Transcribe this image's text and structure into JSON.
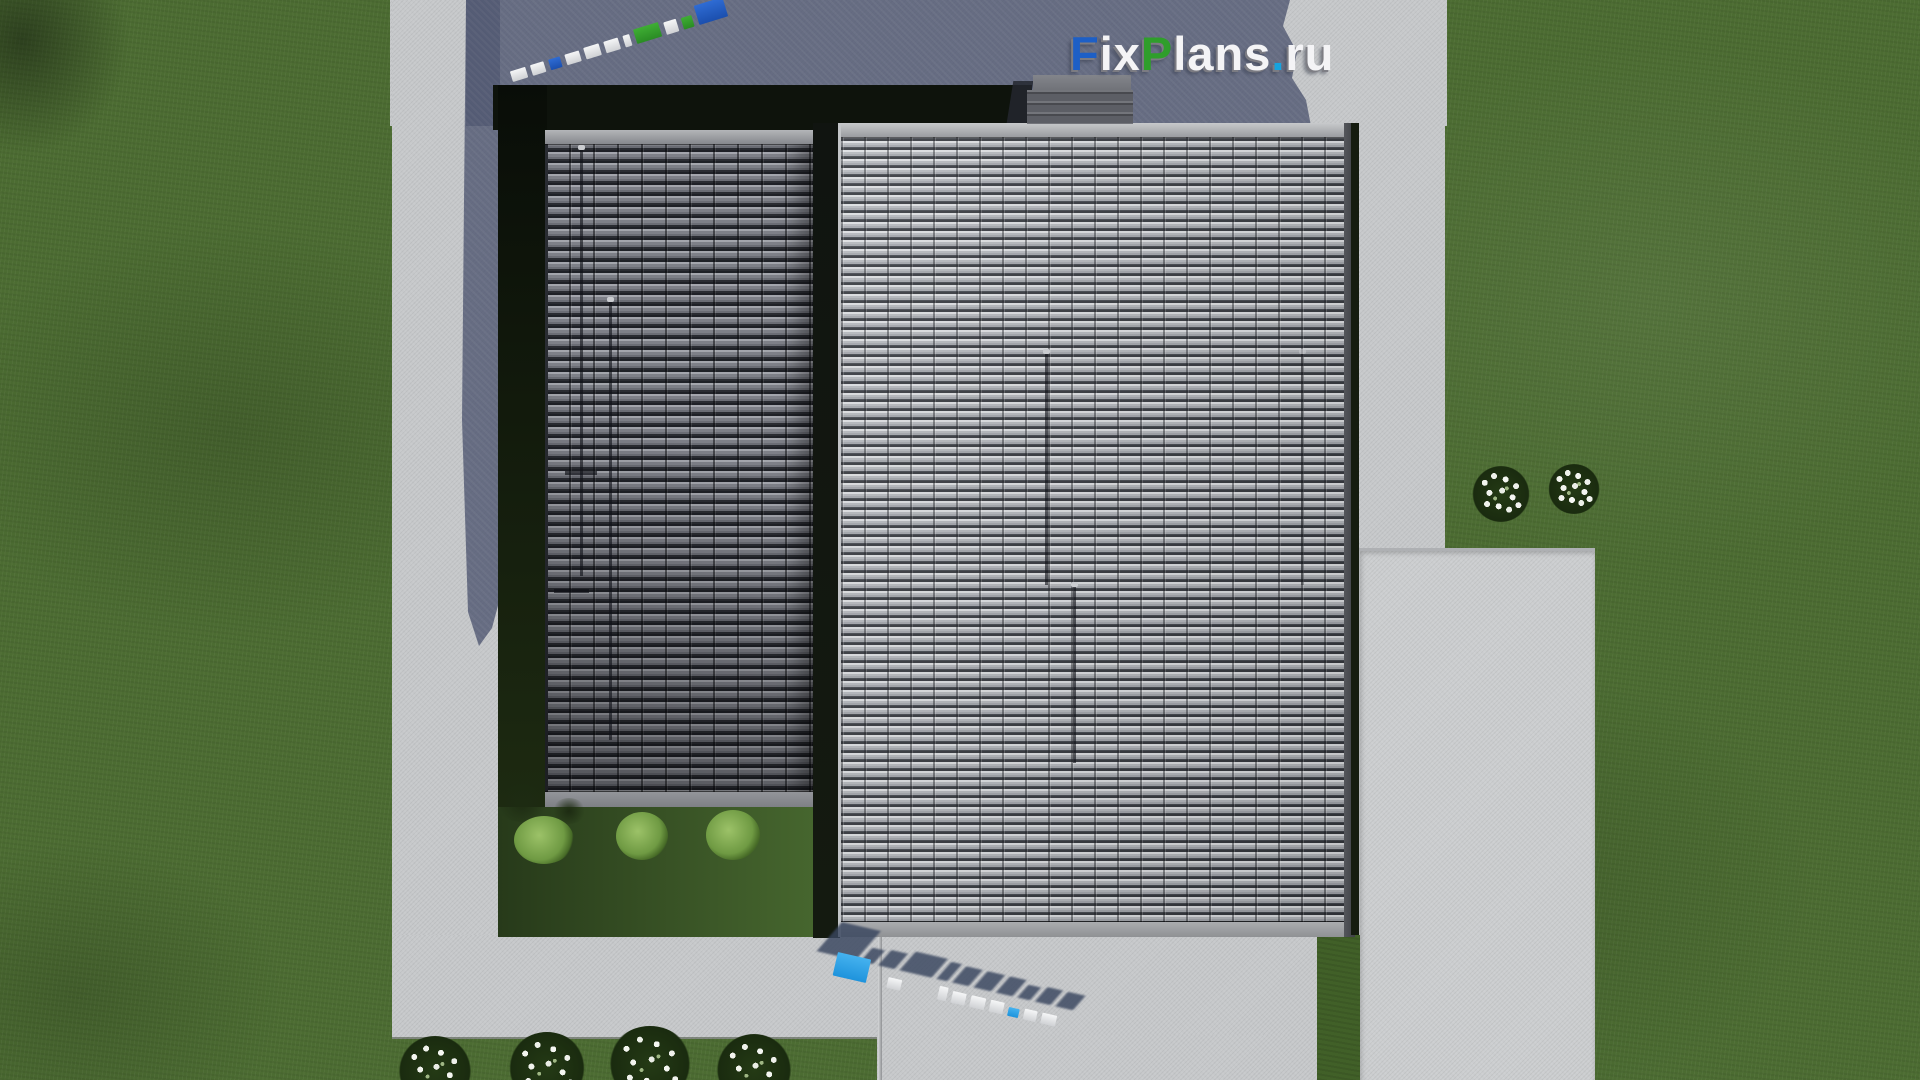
{
  "scene": {
    "description": "Aerial top-down 3D render of a house: two metal-tile roof sections, chimney, concrete paths, paved patio, lawn with white flower bushes",
    "watermark": {
      "text": "FixPlans.ru",
      "parts": {
        "f": "F",
        "ix": "ix",
        "p": "P",
        "lans": "lans",
        "dot": ".",
        "ru": "ru"
      },
      "instances": [
        "top-right overlay logo",
        "mirrored skewed logo on shaded pavement (top-left)",
        "extruded 3D logo standing on pavement (bottom)"
      ]
    },
    "colors": {
      "brand_blue": "#1d5fc6",
      "brand_green": "#2f9e2b",
      "brand_dot_blue": "#16a3de",
      "ground_mark_blue": "#2ba2e8",
      "ground_mark_green": "#3cc41e",
      "grass": "#4c6c32",
      "grass_deep_shadow": "#0e130c",
      "concrete": "#c6c8ca",
      "concrete_in_shadow": "#6d7386",
      "roof_sunlit": "#9fa2a7",
      "roof_shaded": "#6f7178",
      "chimney": "#5c5e65"
    },
    "objects": {
      "lawn": "lawn",
      "roof_left": "left roof section (in shade)",
      "roof_right": "right roof section (sunlit)",
      "chimney": "chimney",
      "paths": "concrete paths",
      "patio": "paved patio",
      "flowers": "white flower bushes",
      "shrubs": "green shrubs at house edge",
      "shadow": "building shadow cast to upper left"
    }
  }
}
